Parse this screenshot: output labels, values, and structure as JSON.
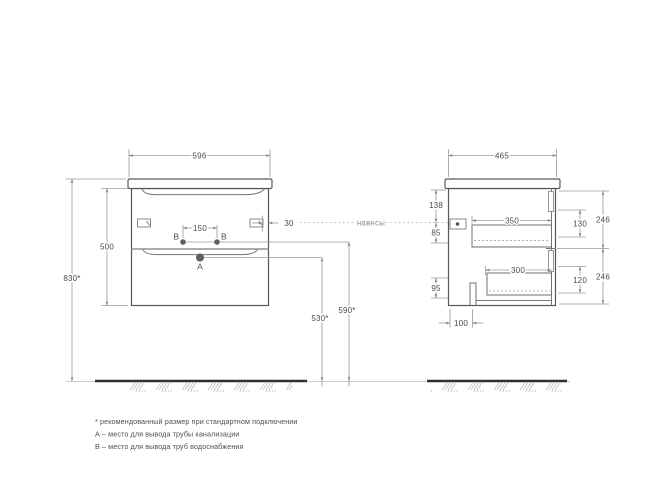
{
  "front": {
    "dims": {
      "width": "596",
      "height": "500",
      "total_height": "830*",
      "tap_holes_spacing": "150",
      "hanger_offset": "30",
      "drain_outlet_height": "530*",
      "water_outlet_height": "590*"
    },
    "points": {
      "drain": "A",
      "water_left": "B",
      "water_right": "B"
    }
  },
  "side": {
    "dims": {
      "depth": "465",
      "hanger_from_top": "138",
      "hanger_to_drawer": "85",
      "drawer1_opening": "350",
      "drawer1_inner_height": "130",
      "drawer1_front_height": "246",
      "lower_clearance": "95",
      "drawer2_opening": "300",
      "drawer2_inner_height": "120",
      "drawer2_front_height": "246",
      "back_offset": "100"
    }
  },
  "annotations": {
    "hangers": "навесы"
  },
  "footnotes": {
    "line1": "* рекомендованный размер при стандартном подключении",
    "line2": "А – место для вывода трубы канализации",
    "line3": "В – место для вывода труб водоснабжения"
  },
  "colors": {
    "outline": "#575757",
    "dimension": "#9a9a9a",
    "floor": "#2f2f2f",
    "text": "#4a4a4a"
  }
}
